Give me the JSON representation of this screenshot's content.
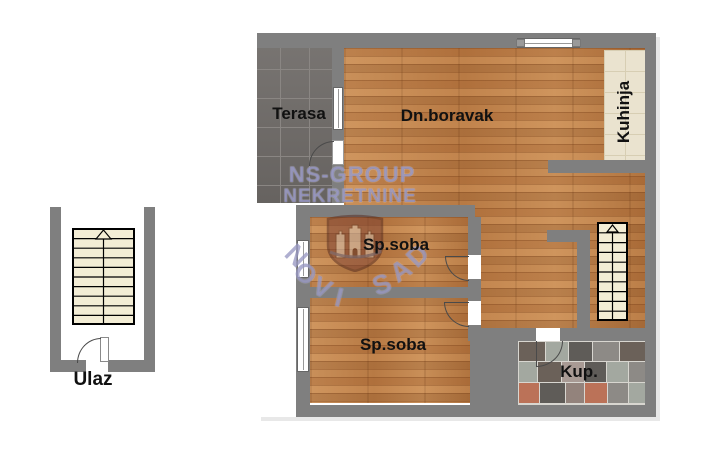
{
  "labels": {
    "entrance": "Ulaz",
    "terrace": "Terasa",
    "living_room": "Dn.boravak",
    "kitchen": "Kuhinja",
    "bedroom": "Sp.soba",
    "bathroom": "Kup."
  },
  "watermark": {
    "line1": "NS-GROUP",
    "line2": "NEKRETNINE",
    "arc_text": "NOVI SAD",
    "arc_letters": [
      "N",
      "O",
      "V",
      "I",
      "S",
      "A",
      "D"
    ],
    "color": "#5f5fa2"
  },
  "colors": {
    "wall": "#7f7f7f",
    "wood_base": "#c08550",
    "terrace_tile": "#6f6b68",
    "kitchen_tile": "#eae3cf",
    "stair_fill": "#f3edd5",
    "background": "#ffffff"
  },
  "bathroom_tiles": {
    "palette": [
      "#6b6159",
      "#a3a8a0",
      "#8d8a86",
      "#5f5c58",
      "#bb7258",
      "#93837c",
      "#a89a94"
    ],
    "rows": [
      {
        "h": 19,
        "bricks": [
          {
            "w": 26,
            "c": 0
          },
          {
            "w": 22,
            "c": 1
          },
          {
            "w": 24,
            "c": 3
          },
          {
            "w": 26,
            "c": 2
          },
          {
            "w": 25,
            "c": 0
          }
        ]
      },
      {
        "h": 20,
        "bricks": [
          {
            "w": 18,
            "c": 1
          },
          {
            "w": 24,
            "c": 0
          },
          {
            "w": 22,
            "c": 6
          },
          {
            "w": 21,
            "c": 3
          },
          {
            "w": 22,
            "c": 1
          },
          {
            "w": 16,
            "c": 2
          }
        ]
      },
      {
        "h": 20,
        "bricks": [
          {
            "w": 20,
            "c": 4
          },
          {
            "w": 26,
            "c": 3
          },
          {
            "w": 18,
            "c": 5
          },
          {
            "w": 22,
            "c": 4
          },
          {
            "w": 21,
            "c": 2
          },
          {
            "w": 16,
            "c": 1
          }
        ]
      }
    ]
  }
}
